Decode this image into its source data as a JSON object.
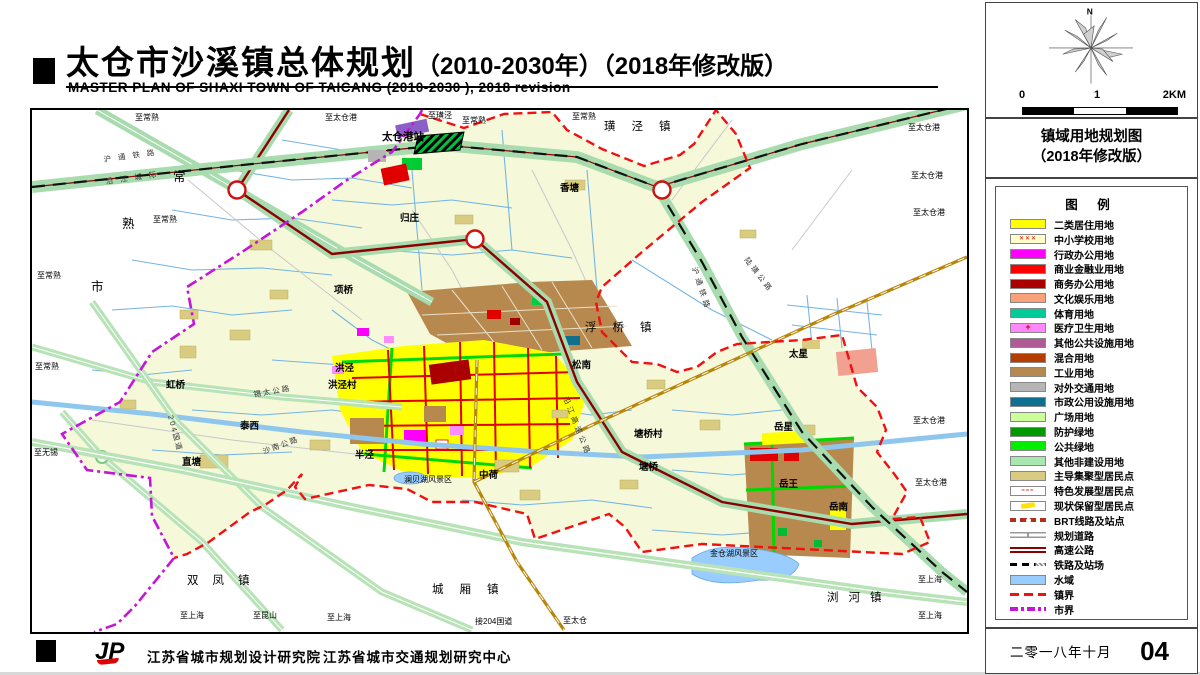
{
  "header": {
    "title_zh": "太仓市沙溪镇总体规划",
    "title_zh_sub": "（2010-2030年）（2018年修改版）",
    "title_en": "MASTER PLAN OF SHAXI TOWN OF TAICANG (2010-2030 ), 2018 revision"
  },
  "sidebar": {
    "compass_label": "N",
    "scale": {
      "t0": "0",
      "t1": "1",
      "t2": "2KM"
    },
    "map_title_line1": "镇域用地规划图",
    "map_title_line2": "（2018年修改版）",
    "legend": {
      "title": "图  例",
      "items": [
        {
          "label": "二类居住用地",
          "swatch": "fill",
          "color": "#ffff00"
        },
        {
          "label": "中小学校用地",
          "swatch": "school",
          "color": "#ffffcc"
        },
        {
          "label": "行政办公用地",
          "swatch": "fill",
          "color": "#ff00ff"
        },
        {
          "label": "商业金融业用地",
          "swatch": "fill",
          "color": "#ff0000"
        },
        {
          "label": "商务办公用地",
          "swatch": "fill",
          "color": "#aa0000"
        },
        {
          "label": "文化娱乐用地",
          "swatch": "fill",
          "color": "#f9a178"
        },
        {
          "label": "体育用地",
          "swatch": "fill",
          "color": "#00cc99"
        },
        {
          "label": "医疗卫生用地",
          "swatch": "med",
          "color": "#ff88ff"
        },
        {
          "label": "其他公共设施用地",
          "swatch": "fill",
          "color": "#b05a96"
        },
        {
          "label": "混合用地",
          "swatch": "fill",
          "color": "#b43e00"
        },
        {
          "label": "工业用地",
          "swatch": "fill",
          "color": "#b7894e"
        },
        {
          "label": "对外交通用地",
          "swatch": "fill",
          "color": "#b5b5b5"
        },
        {
          "label": "市政公用设施用地",
          "swatch": "fill",
          "color": "#0e6f8e"
        },
        {
          "label": "广场用地",
          "swatch": "fill",
          "color": "#ccff99"
        },
        {
          "label": "防护绿地",
          "swatch": "fill",
          "color": "#009900"
        },
        {
          "label": "公共绿地",
          "swatch": "fill",
          "color": "#00ee00"
        },
        {
          "label": "其他非建设用地",
          "swatch": "fill",
          "color": "#a8e8b0"
        },
        {
          "label": "主导集聚型居民点",
          "swatch": "fill",
          "color": "#d9cc80"
        },
        {
          "label": "特色发展型居民点",
          "swatch": "special-res"
        },
        {
          "label": "现状保留型居民点",
          "swatch": "status-res"
        },
        {
          "label": "BRT线路及站点",
          "swatch": "brt"
        },
        {
          "label": "规划道路",
          "swatch": "road"
        },
        {
          "label": "高速公路",
          "swatch": "highway"
        },
        {
          "label": "铁路及站场",
          "swatch": "railway"
        },
        {
          "label": "水域",
          "swatch": "fill",
          "color": "#99ccff"
        },
        {
          "label": "镇界",
          "swatch": "townline"
        },
        {
          "label": "市界",
          "swatch": "cityline"
        }
      ]
    },
    "date": "二零一八年十月",
    "page": "04"
  },
  "footer": {
    "logo": "JP",
    "org1": "江苏省城市规划设计研究院",
    "org2": "江苏省城市交通规划研究中心"
  },
  "map": {
    "labels": [
      {
        "t": "太仓港站",
        "x": 350,
        "y": 30,
        "c": "station"
      },
      {
        "t": "香塘",
        "x": 528,
        "y": 81,
        "c": "town"
      },
      {
        "t": "归庄",
        "x": 368,
        "y": 111,
        "c": "town"
      },
      {
        "t": "项桥",
        "x": 302,
        "y": 183,
        "c": "town"
      },
      {
        "t": "洪泾",
        "x": 303,
        "y": 261,
        "c": "town"
      },
      {
        "t": "洪泾村",
        "x": 296,
        "y": 278,
        "c": "town"
      },
      {
        "t": "虹桥",
        "x": 134,
        "y": 278,
        "c": "town"
      },
      {
        "t": "泰西",
        "x": 208,
        "y": 319,
        "c": "town"
      },
      {
        "t": "直塘",
        "x": 150,
        "y": 355,
        "c": "town"
      },
      {
        "t": "半泾",
        "x": 323,
        "y": 348,
        "c": "town"
      },
      {
        "t": "中荷",
        "x": 447,
        "y": 368,
        "c": "town"
      },
      {
        "t": "松南",
        "x": 540,
        "y": 258,
        "c": "town"
      },
      {
        "t": "塘桥村",
        "x": 602,
        "y": 327,
        "c": "town"
      },
      {
        "t": "塘桥",
        "x": 607,
        "y": 360,
        "c": "town"
      },
      {
        "t": "太星",
        "x": 757,
        "y": 247,
        "c": "town"
      },
      {
        "t": "岳星",
        "x": 742,
        "y": 320,
        "c": "town"
      },
      {
        "t": "岳王",
        "x": 747,
        "y": 377,
        "c": "town"
      },
      {
        "t": "岳南",
        "x": 797,
        "y": 400,
        "c": "town"
      },
      {
        "t": "澜贝湖风景区",
        "x": 372,
        "y": 372,
        "c": "scenic"
      },
      {
        "t": "金仓湖风景区",
        "x": 678,
        "y": 446,
        "c": "scenic"
      },
      {
        "t": "璜泾镇",
        "x": 572,
        "y": 20,
        "c": "townsp",
        "ls": 16
      },
      {
        "t": "浮桥镇",
        "x": 553,
        "y": 221,
        "c": "townsp",
        "ls": 16
      },
      {
        "t": "城厢镇",
        "x": 400,
        "y": 483,
        "c": "townsp",
        "ls": 16
      },
      {
        "t": "双凤镇",
        "x": 155,
        "y": 474,
        "c": "townsp",
        "ls": 14
      },
      {
        "t": "浏河镇",
        "x": 795,
        "y": 491,
        "c": "townsp",
        "ls": 10
      },
      {
        "t": "常",
        "x": 141,
        "y": 71,
        "c": "city"
      },
      {
        "t": "熟",
        "x": 90,
        "y": 118,
        "c": "city"
      },
      {
        "t": "市",
        "x": 59,
        "y": 181,
        "c": "city"
      },
      {
        "t": "至常熟",
        "x": 103,
        "y": 10,
        "c": "edge"
      },
      {
        "t": "至常熟",
        "x": 430,
        "y": 13,
        "c": "edge"
      },
      {
        "t": "至常熟",
        "x": 540,
        "y": 9,
        "c": "edge"
      },
      {
        "t": "至常熟",
        "x": 121,
        "y": 112,
        "c": "edge"
      },
      {
        "t": "至常熟",
        "x": 5,
        "y": 168,
        "c": "edge"
      },
      {
        "t": "至常熟",
        "x": 3,
        "y": 259,
        "c": "edge"
      },
      {
        "t": "至璜泾",
        "x": 396,
        "y": 8,
        "c": "edge"
      },
      {
        "t": "至太仓港",
        "x": 293,
        "y": 10,
        "c": "edge"
      },
      {
        "t": "至太仓港",
        "x": 876,
        "y": 20,
        "c": "edge"
      },
      {
        "t": "至太仓港",
        "x": 879,
        "y": 68,
        "c": "edge"
      },
      {
        "t": "至太仓港",
        "x": 881,
        "y": 105,
        "c": "edge"
      },
      {
        "t": "至太仓港",
        "x": 881,
        "y": 313,
        "c": "edge"
      },
      {
        "t": "至太仓港",
        "x": 883,
        "y": 375,
        "c": "edge"
      },
      {
        "t": "至无锡",
        "x": 2,
        "y": 345,
        "c": "edge"
      },
      {
        "t": "至上海",
        "x": 148,
        "y": 508,
        "c": "edge"
      },
      {
        "t": "至上海",
        "x": 295,
        "y": 510,
        "c": "edge"
      },
      {
        "t": "至上海",
        "x": 886,
        "y": 472,
        "c": "edge"
      },
      {
        "t": "至上海",
        "x": 886,
        "y": 508,
        "c": "edge"
      },
      {
        "t": "至昆山",
        "x": 221,
        "y": 508,
        "c": "edge"
      },
      {
        "t": "至太仓",
        "x": 531,
        "y": 513,
        "c": "edge"
      },
      {
        "t": "接204国道",
        "x": 443,
        "y": 514,
        "c": "edge"
      },
      {
        "t": "沪通铁路",
        "x": 72,
        "y": 52,
        "c": "road",
        "r": -8,
        "ls": 7
      },
      {
        "t": "沿江城际",
        "x": 74,
        "y": 74,
        "c": "road",
        "r": -8,
        "ls": 7
      },
      {
        "t": "沪通铁路",
        "x": 660,
        "y": 158,
        "c": "road",
        "r": 72,
        "ls": 4
      },
      {
        "t": "沿江高速公路",
        "x": 531,
        "y": 288,
        "c": "road",
        "r": 68,
        "ls": 3
      },
      {
        "t": "陆璜公路",
        "x": 712,
        "y": 150,
        "c": "road",
        "r": 52,
        "ls": 3
      },
      {
        "t": "204国道",
        "x": 136,
        "y": 306,
        "c": "road",
        "r": 75,
        "ls": 2
      },
      {
        "t": "锡太公路",
        "x": 222,
        "y": 287,
        "c": "road",
        "r": -10,
        "ls": 2
      },
      {
        "t": "沙南公路",
        "x": 232,
        "y": 344,
        "c": "road",
        "r": -20,
        "ls": 2
      }
    ]
  }
}
